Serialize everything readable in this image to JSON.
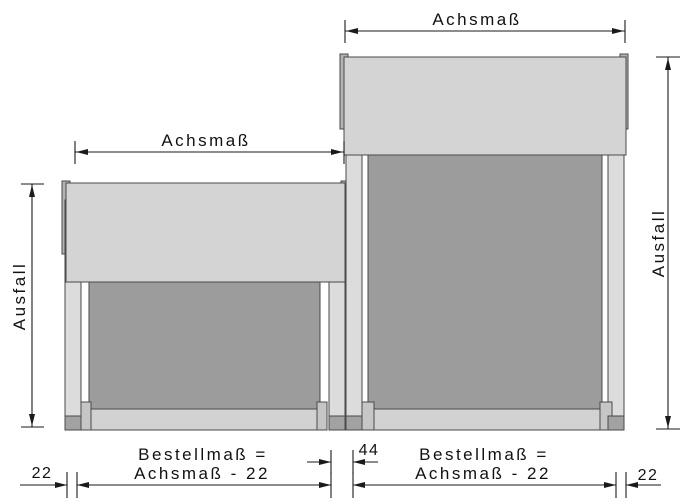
{
  "drawing": {
    "description": "Technical dimension drawing of two coupled vertical awnings (small left unit, large right unit)",
    "labels": {
      "achsmass_top": "Achsmaß",
      "achsmass_left": "Achsmaß",
      "ausfall_left": "Ausfall",
      "ausfall_right": "Ausfall",
      "gap_left": "22",
      "gap_middle": "44",
      "gap_right": "22",
      "bestell_left_line1": "Bestellmaß =",
      "bestell_left_line2": "Achsmaß - 22",
      "bestell_right_line1": "Bestellmaß =",
      "bestell_right_line2": "Achsmaß - 22"
    },
    "colors": {
      "cassette": "#d4d4d4",
      "fabric": "#9c9c9c",
      "rail": "#dcdcdc",
      "bracket": "#b3b3b3",
      "end_cap": "#c6c6c6",
      "rail_foot": "#a2a2a2",
      "bottom_bar": "#d2d2d2",
      "dimension_line": "#1a1a1a"
    }
  }
}
